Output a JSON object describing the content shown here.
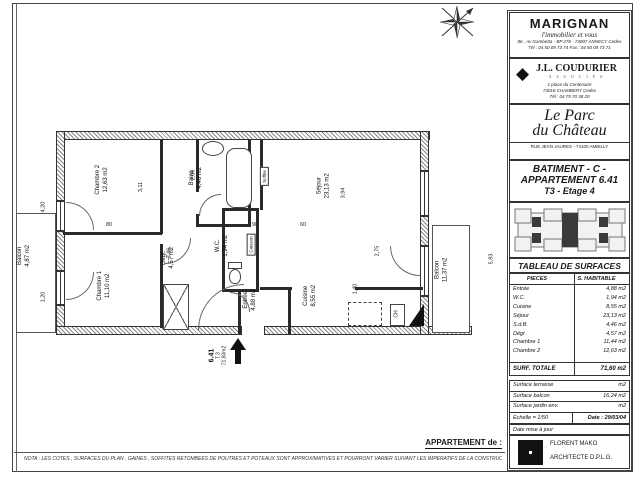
{
  "sidebar": {
    "marignan": {
      "name": "MARIGNAN",
      "tagline": "l'immobilier et vous",
      "address": "86 , Av Gambetta - BP 276 - 74007 ANNECY Cedex",
      "phone": "Tél : 04 50 09 73 74 Fax : 04 50 09 73 71"
    },
    "coudurier": {
      "diamond": "◆",
      "name": "J.L. COUDURIER",
      "subtitle": "A S S O C I E S",
      "address": "1 place du Centenaire",
      "city": "73016 CHAMBERY Cedex",
      "phone": "Tél : 04 79 70 38 20"
    },
    "residence": {
      "line1": "Le  Parc",
      "line2": "du Château",
      "address": "RUE  JEAN  JAURES  -  74100  AMBILLY"
    },
    "apartment": {
      "batiment": "BATIMENT - C -",
      "appartement": "APPARTEMENT 6.41",
      "type_etage": "T3   -   Etage 4"
    },
    "surfaces": {
      "title": "TABLEAU DE SURFACES",
      "col1": "PIECES",
      "col2": "S. HABITABLE",
      "rows": [
        [
          "Entrée",
          "4,88  m2"
        ],
        [
          "W.C.",
          "1,94  m2"
        ],
        [
          "Cuisine",
          "8,55  m2"
        ],
        [
          "Séjour",
          "23,13  m2"
        ],
        [
          "S.d.B.",
          "4,46  m2"
        ],
        [
          "Dégt",
          "4,57  m2"
        ],
        [
          "Chambre 1",
          "11,44  m2"
        ],
        [
          "Chambre 2",
          "12,63  m2"
        ]
      ],
      "total_label": "SURF. TOTALE",
      "total_value": "71,60 m2",
      "extra_rows": [
        [
          "Surface terrasse",
          "m2"
        ],
        [
          "Surface balcon",
          "16,24  m2"
        ],
        [
          "Surface jardin env.",
          "m2"
        ]
      ],
      "echelle": "Echelle  =   1/50",
      "date": "Date :  29/03/04",
      "maj": "Date mise à jour"
    },
    "architect": {
      "name": "FLORENT MAKO",
      "title": "ARCHITECTE D.P.L.G."
    }
  },
  "plan": {
    "rooms": [
      {
        "name": "Balcon",
        "area": "4,87 m2",
        "x": 14,
        "y": 248,
        "rot": -90
      },
      {
        "name": "Chambre 2",
        "area": "12,63 m2",
        "x": 88,
        "y": 172,
        "rot": -90
      },
      {
        "name": "Chambre 1",
        "area": "11,10 m2",
        "x": 90,
        "y": 278,
        "rot": -90
      },
      {
        "name": "Bains",
        "area": "4,46 m2",
        "x": 186,
        "y": 170,
        "rot": -90
      },
      {
        "name": "Dégt.",
        "area": "4,57 m2",
        "x": 158,
        "y": 250,
        "rot": -90
      },
      {
        "name": "W.C.",
        "area": "1,94 m2",
        "x": 212,
        "y": 238,
        "rot": -90
      },
      {
        "name": "Séjour",
        "area": "23,13 m2",
        "x": 312,
        "y": 178,
        "rot": -90
      },
      {
        "name": "Entrée",
        "area": "4,88 m2",
        "x": 240,
        "y": 292,
        "rot": -90
      },
      {
        "name": "Cuisine",
        "area": "8,55 m2",
        "x": 300,
        "y": 288,
        "rot": -90
      },
      {
        "name": "Balcon",
        "area": "11,37 m2",
        "x": 430,
        "y": 262,
        "rot": -90
      }
    ],
    "dims": [
      {
        "text": "4,20",
        "x": 38,
        "y": 204,
        "rot": -90
      },
      {
        "text": "1,20",
        "x": 38,
        "y": 294,
        "rot": -90
      },
      {
        "text": "3,11",
        "x": 136,
        "y": 184,
        "rot": -90
      },
      {
        "text": "2,06",
        "x": 188,
        "y": 172,
        "rot": -90
      },
      {
        "text": "3,94",
        "x": 338,
        "y": 190,
        "rot": -90
      },
      {
        "text": "3,86",
        "x": 164,
        "y": 250,
        "rot": -90
      },
      {
        "text": "2,75",
        "x": 372,
        "y": 248,
        "rot": -90
      },
      {
        "text": "1,40",
        "x": 350,
        "y": 286,
        "rot": -90
      },
      {
        "text": "5,93",
        "x": 486,
        "y": 256,
        "rot": -90
      },
      {
        "text": "80",
        "x": 106,
        "y": 222,
        "rot": 0
      },
      {
        "text": "90",
        "x": 252,
        "y": 222,
        "rot": 0
      },
      {
        "text": "60",
        "x": 300,
        "y": 222,
        "rot": 0
      }
    ],
    "annotations": {
      "soffite": "Soffite",
      "caisson": "Caisson",
      "ch": "CH",
      "arrow_no": "6.41",
      "arrow_type": "T.3",
      "arrow_surf": "71,60m2"
    }
  },
  "footer": {
    "appartement_de": "APPARTEMENT de :",
    "nota": "NOTA : LES COTES , SURFACES DU PLAN , GAINES , SOFFITES RETOMBEES DE POUTRES ET POTEAUX SONT APPROXIMATIVES ET POURRONT VARIER SUIVANT LES IMPERATIFS DE LA CONSTRUCTION"
  }
}
